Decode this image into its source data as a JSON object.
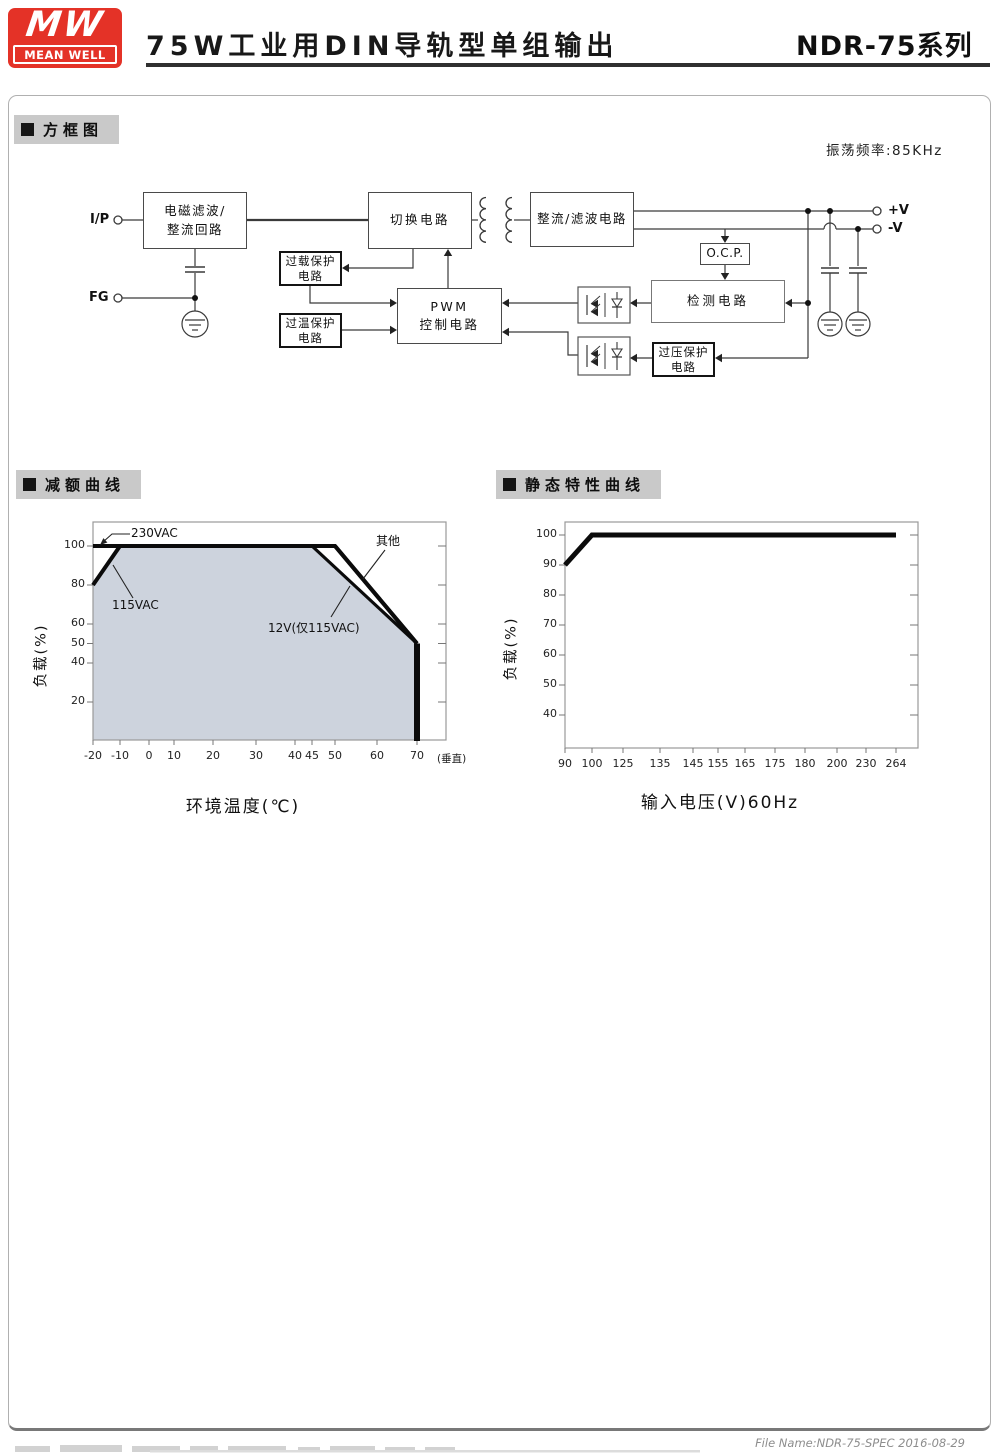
{
  "header": {
    "logo": {
      "monogram": "MW",
      "name": "MEAN WELL"
    },
    "title": "75W工业用DIN导轨型单组输出",
    "series": "NDR-75系列"
  },
  "sections": {
    "block_diagram": "方框图",
    "derating_curve": "减额曲线",
    "static_curve": "静态特性曲线"
  },
  "block_diagram": {
    "oscillation_note": "振荡频率:85KHz",
    "terminals": {
      "input": "I/P",
      "ground": "FG",
      "v_plus": "+V",
      "v_minus": "-V"
    },
    "boxes": {
      "emi_filter": "电磁滤波/\n整流回路",
      "switching": "切换电路",
      "rectifier_filter": "整流/滤波电路",
      "overload_protection": "过载保护\n电路",
      "overtemp_protection": "过温保护\n电路",
      "pwm_control": "PWM\n控制电路",
      "ocp": "O.C.P.",
      "detection": "检测电路",
      "overvoltage_protection": "过压保护\n电路"
    }
  },
  "chart_data": [
    {
      "type": "line",
      "title": "减额曲线",
      "xlabel": "环境温度(℃)",
      "ylabel": "负载(%)",
      "x_ticks": [
        -20,
        -10,
        0,
        10,
        20,
        30,
        40,
        45,
        50,
        60,
        70
      ],
      "x_axis_suffix": "(垂直)",
      "y_ticks": [
        20,
        40,
        50,
        60,
        80,
        100
      ],
      "ylim": [
        0,
        110
      ],
      "grid": false,
      "series": [
        {
          "name": "230VAC",
          "points": [
            [
              -20,
              100
            ],
            [
              50,
              100
            ],
            [
              70,
              50
            ]
          ]
        },
        {
          "name": "115VAC",
          "points": [
            [
              -20,
              80
            ],
            [
              -10,
              100
            ]
          ]
        },
        {
          "name": "12V(仅115VAC)",
          "points": [
            [
              45,
              100
            ],
            [
              70,
              50
            ]
          ]
        },
        {
          "name": "其他",
          "points": [
            [
              50,
              100
            ],
            [
              70,
              50
            ]
          ]
        },
        {
          "name": "vertical-drop",
          "points": [
            [
              70,
              50
            ],
            [
              70,
              0
            ]
          ]
        }
      ],
      "shaded_polygon": [
        [
          -20,
          80
        ],
        [
          -10,
          100
        ],
        [
          45,
          100
        ],
        [
          70,
          50
        ],
        [
          70,
          0
        ],
        [
          -20,
          0
        ]
      ],
      "annotations": [
        "230VAC",
        "115VAC",
        "12V(仅115VAC)",
        "其他"
      ]
    },
    {
      "type": "line",
      "title": "静态特性曲线",
      "xlabel": "输入电压(V)60Hz",
      "ylabel": "负载(%)",
      "x_ticks": [
        90,
        100,
        125,
        135,
        145,
        155,
        165,
        175,
        180,
        200,
        230,
        264
      ],
      "y_ticks": [
        40,
        50,
        60,
        70,
        80,
        90,
        100
      ],
      "ylim": [
        30,
        105
      ],
      "grid": false,
      "series": [
        {
          "name": "负载",
          "points": [
            [
              90,
              90
            ],
            [
              100,
              100
            ],
            [
              264,
              100
            ]
          ]
        }
      ]
    }
  ],
  "colors": {
    "brand_red": "#e43227",
    "shade": "#cdd3dd",
    "section_strip": "#c9c9c9"
  },
  "footer": {
    "file_name": "File Name:NDR-75-SPEC  2016-08-29"
  }
}
